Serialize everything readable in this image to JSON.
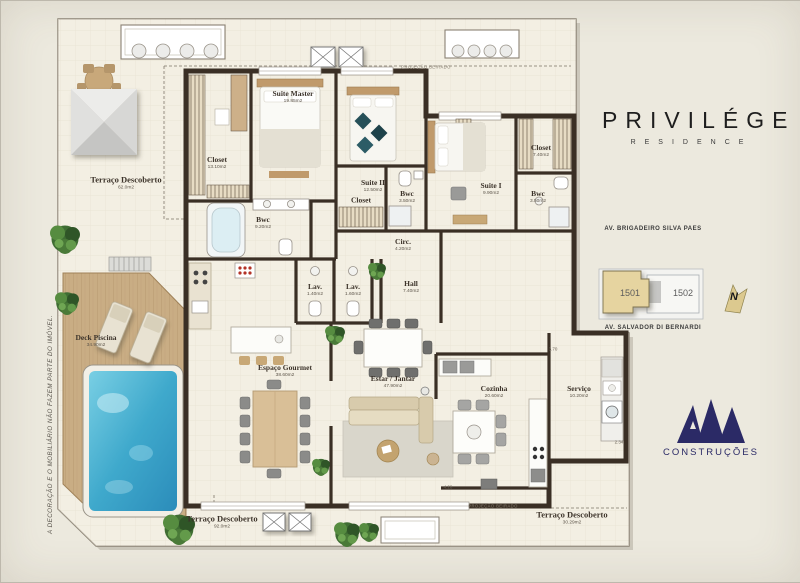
{
  "branding": {
    "title_word": "PRIVILÉGE",
    "subtitle_word": "RESIDENCE",
    "builder": "CONSTRUÇÕES"
  },
  "disclaimer": "A DECORAÇÃO E O MOBILIÁRIO NÃO FAZEM PARTE DO IMÓVEL.",
  "projection": {
    "top": "PROJEÇÃO BEIRADO",
    "bottom": "PROJEÇÃO BEIRADO"
  },
  "keyplan": {
    "street_top": "AV. BRIGADEIRO SILVA PAES",
    "street_bottom": "AV. SALVADOR DI BERNARDI",
    "unit_main": "1501",
    "unit_secondary": "1502",
    "north": "N"
  },
  "rooms": [
    {
      "name": "Terraço Descoberto",
      "area": "62.0m2"
    },
    {
      "name": "Closet",
      "area": "13.10m2"
    },
    {
      "name": "Suite Master",
      "area": "19.85m2"
    },
    {
      "name": "Suite II",
      "area": "12.50m2"
    },
    {
      "name": "Closet",
      "area": ""
    },
    {
      "name": "Bwc",
      "area": "3.50m2"
    },
    {
      "name": "Suite I",
      "area": "9.90m2"
    },
    {
      "name": "Closet",
      "area": "7.40m2"
    },
    {
      "name": "Bwc",
      "area": "3.50m2"
    },
    {
      "name": "Bwc",
      "area": "9.20m2"
    },
    {
      "name": "Circ.",
      "area": "4.20m2"
    },
    {
      "name": "Lav.",
      "area": "1.40m2"
    },
    {
      "name": "Lav.",
      "area": "1.60m2"
    },
    {
      "name": "Hall",
      "area": "7.40m2"
    },
    {
      "name": "Deck Piscina",
      "area": "34.90m2"
    },
    {
      "name": "Espaço Gourmet",
      "area": "38.60m2"
    },
    {
      "name": "Estar / Jantar",
      "area": "47.90m2"
    },
    {
      "name": "Cozinha",
      "area": "20.60m2"
    },
    {
      "name": "Serviço",
      "area": "10.20m2"
    },
    {
      "name": "Terraço Descoberto",
      "area": "92.0m2"
    },
    {
      "name": "Terraço Descoberto",
      "area": "30.29m2"
    }
  ],
  "dims": [
    {
      "v": "3.70"
    },
    {
      "v": "2.34"
    },
    {
      "v": "4.28"
    }
  ],
  "colors": {
    "wall": "#3a2f25",
    "pool": "#3fa9cc",
    "deck": "#c9ad84",
    "unit_highlight": "#e6d4a0",
    "logo_navy": "#2b2a66"
  }
}
